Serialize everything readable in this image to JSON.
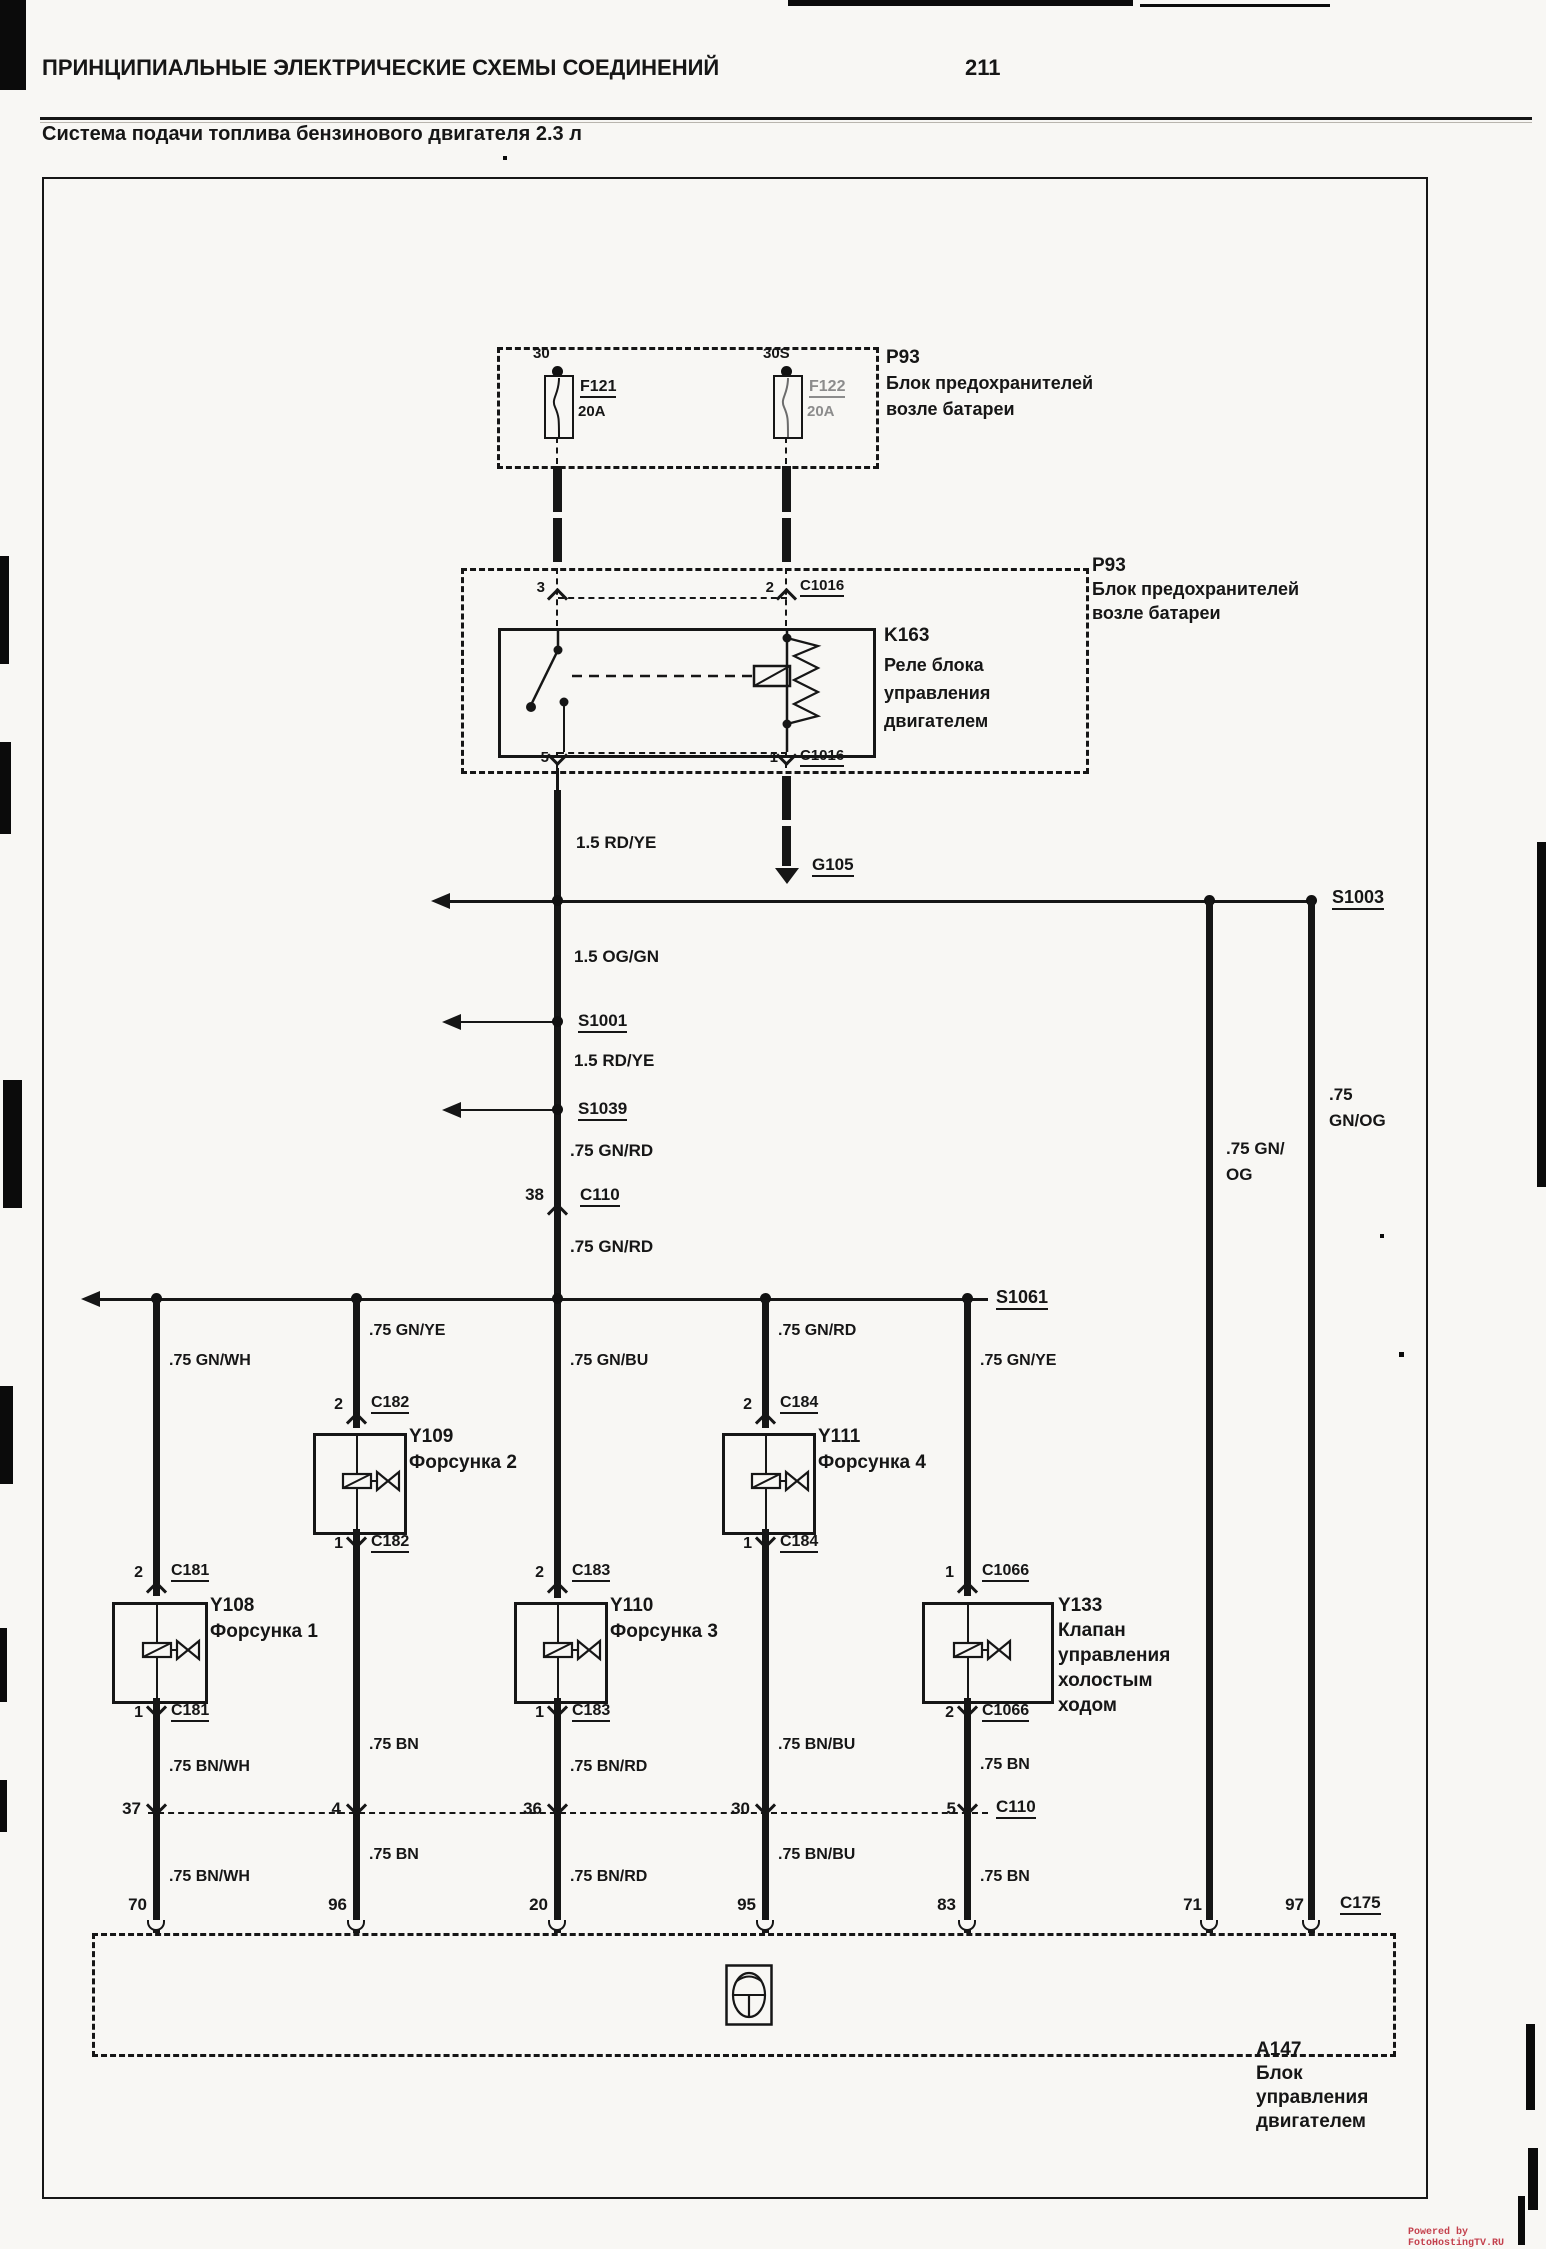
{
  "page": {
    "header": "ПРИНЦИПИАЛЬНЫЕ ЭЛЕКТРИЧЕСКИЕ СХЕМЫ СОЕДИНЕНИЙ",
    "page_number": "211",
    "title": "Система подачи топлива бензинового двигателя 2.3 л",
    "watermark": "Powered by FotoHostingTV.RU"
  },
  "colors": {
    "ink": "#161616",
    "paper": "#f8f7f4",
    "watermark_red": "#c4424e"
  },
  "fuse_box": {
    "id": "P93",
    "name_lines": [
      "Блок предохранителей",
      "возле батареи"
    ],
    "fuses": [
      {
        "terminal": "30",
        "id": "F121",
        "rating": "20A"
      },
      {
        "terminal": "30S",
        "id": "F122",
        "rating": "20A"
      }
    ]
  },
  "relay_box": {
    "id": "P93",
    "name_lines": [
      "Блок предохранителей",
      "возле батареи"
    ],
    "relay_id": "K163",
    "relay_name_lines": [
      "Реле блока",
      "управления",
      "двигателем"
    ],
    "pin_switch_top": "3",
    "pin_switch_bottom": "5",
    "pin_coil_top": "2",
    "pin_coil_bottom": "1",
    "connector_top": "C1016",
    "connector_bottom": "C1016"
  },
  "ground": {
    "id": "G105"
  },
  "trunk": {
    "wire_relay_out": "1.5 RD/YE",
    "splice_a": "S1003",
    "wire_b": "1.5 OG/GN",
    "splice_b": "S1001",
    "wire_c": "1.5 RD/YE",
    "splice_c": "S1039",
    "wire_d": ".75 GN/RD",
    "c110_pin": "38",
    "c110": "C110",
    "wire_e": ".75 GN/RD",
    "splice_d": "S1061"
  },
  "branches": [
    {
      "wire_top": ".75 GN/WH",
      "pin_top": "2",
      "conn_top": "C181",
      "id": "Y108",
      "name_lines": [
        "Форсунка 1"
      ],
      "pin_bot": "1",
      "conn_bot": "C181",
      "wire_mid": ".75 BN/WH",
      "row_pin": "37",
      "wire_low": ".75 BN/WH",
      "ecu_pin": "70"
    },
    {
      "wire_top": ".75 GN/YE",
      "pin_top": "2",
      "conn_top": "C182",
      "id": "Y109",
      "name_lines": [
        "Форсунка 2"
      ],
      "pin_bot": "1",
      "conn_bot": "C182",
      "wire_mid": ".75 BN",
      "row_pin": "4",
      "wire_low": ".75 BN",
      "ecu_pin": "96"
    },
    {
      "wire_top": ".75 GN/BU",
      "pin_top": "2",
      "conn_top": "C183",
      "id": "Y110",
      "name_lines": [
        "Форсунка 3"
      ],
      "pin_bot": "1",
      "conn_bot": "C183",
      "wire_mid": ".75 BN/RD",
      "row_pin": "36",
      "wire_low": ".75 BN/RD",
      "ecu_pin": "20"
    },
    {
      "wire_top": ".75 GN/RD",
      "pin_top": "2",
      "conn_top": "C184",
      "id": "Y111",
      "name_lines": [
        "Форсунка 4"
      ],
      "pin_bot": "1",
      "conn_bot": "C184",
      "wire_mid": ".75 BN/BU",
      "row_pin": "30",
      "wire_low": ".75 BN/BU",
      "ecu_pin": "95"
    },
    {
      "wire_top": ".75 GN/YE",
      "pin_top": "1",
      "conn_top": "C1066",
      "id": "Y133",
      "name_lines": [
        "Клапан",
        "управления",
        "холостым",
        "ходом"
      ],
      "pin_bot": "2",
      "conn_bot": "C1066",
      "wire_mid": ".75 BN",
      "row_pin": "5",
      "row_conn": "C110",
      "wire_low": ".75 BN",
      "ecu_pin": "83"
    }
  ],
  "right_wires": [
    {
      "label_lines": [
        ".75 GN/",
        "OG"
      ],
      "ecu_pin": "71"
    },
    {
      "label_lines": [
        ".75",
        "GN/OG"
      ],
      "ecu_pin": "97"
    }
  ],
  "ecu": {
    "connector": "C175",
    "id": "A147",
    "name_lines": [
      "Блок",
      "управления",
      "двигателем"
    ]
  }
}
